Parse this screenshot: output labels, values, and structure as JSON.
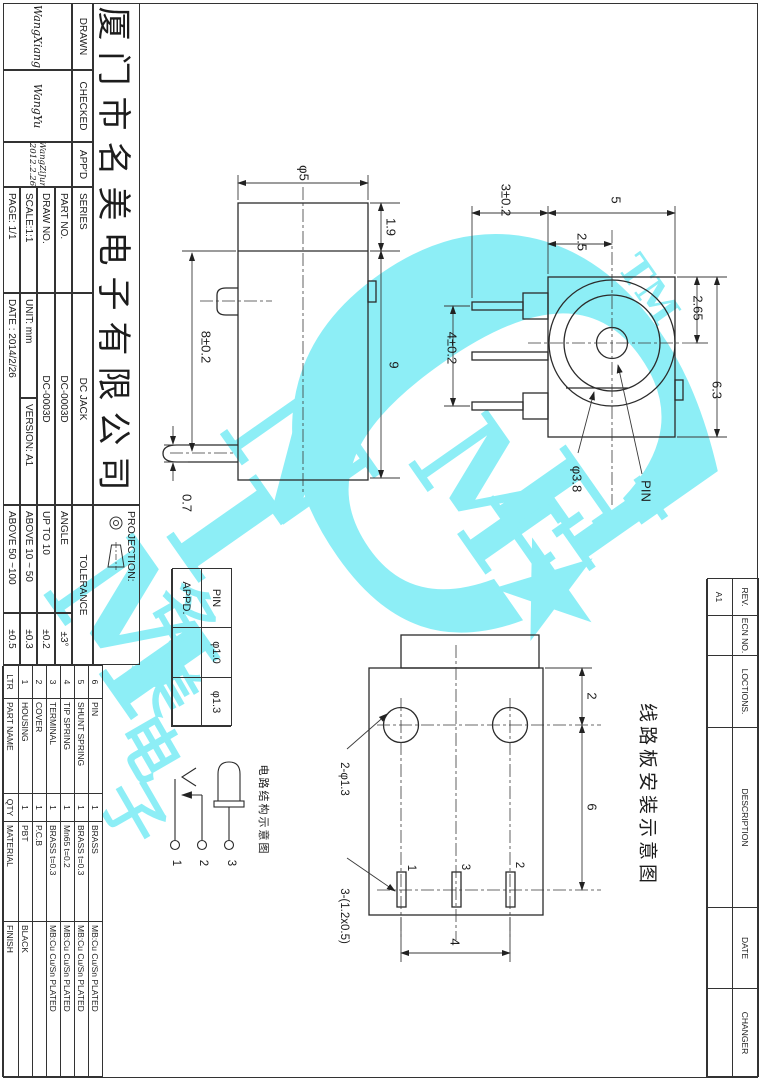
{
  "title_block": {
    "company": "厦门市名美电子有限公司",
    "drawn_label": "DRAWN",
    "drawn_sig": "WangXiang",
    "checked_label": "CHECKED",
    "checked_sig": "WangYu",
    "appd_label": "APP'D",
    "appd_sig": "WangZiJun",
    "appd_sig_date": "2012.2.26",
    "series_label": "SERIES",
    "series_value": "DC JACK",
    "part_no_label": "PART NO.",
    "part_no_value": "DC-0003D",
    "draw_no_label": "DRAW NO.",
    "draw_no_value": "DC-0003D",
    "scale": "SCALE:1:1",
    "unit": "UNIT: mm",
    "version": "VERSION: A1",
    "page": "PAGE: 1/1",
    "date": "DATE : 2014/2/26",
    "projection_label": "PROJECTION:",
    "tolerance": {
      "header": "TOLERANCE",
      "rows": [
        {
          "range": "ANGLE",
          "value": "±3°"
        },
        {
          "range": "UP TO 10",
          "value": "±0.2"
        },
        {
          "range": "ABOVE 10 ~ 50",
          "value": "±0.3"
        },
        {
          "range": "ABOVE 50 ~100",
          "value": "±0.5"
        }
      ]
    }
  },
  "parts_table": {
    "headers": {
      "ltr": "LTR",
      "name": "PART NAME",
      "qty": "QTY",
      "material": "MATERIAL",
      "finish": "FINISH"
    },
    "rows": [
      {
        "ltr": "6",
        "name": "PIN",
        "qty": "1",
        "material": "BRASS",
        "finish": "MB:Cu  Cu/Sn  PLATED"
      },
      {
        "ltr": "5",
        "name": "SHUNT SPRING",
        "qty": "1",
        "material": "BRASS t=0.3",
        "finish": "MB:Cu  Cu/Sn  PLATED"
      },
      {
        "ltr": "4",
        "name": "TIP SPRING",
        "qty": "1",
        "material": "Mn65 t=0.2",
        "finish": "MB:Cu  Cu/Sn  PLATED"
      },
      {
        "ltr": "3",
        "name": "TERMINAL",
        "qty": "1",
        "material": "BRASS t=0.3",
        "finish": "MB:Cu  Cu/Sn  PLATED"
      },
      {
        "ltr": "2",
        "name": "COVER",
        "qty": "1",
        "material": "P.C.B",
        "finish": ""
      },
      {
        "ltr": "1",
        "name": "HOUSING",
        "qty": "1",
        "material": "PBT",
        "finish": "BLACK"
      }
    ]
  },
  "pin_table": {
    "r1c1": "PIN",
    "r1c2": "φ1.0",
    "r1c3": "φ1.3",
    "r2c1": "APPD.",
    "r2c2": "",
    "r2c3": ""
  },
  "revision_table": {
    "rev_label": "REV.",
    "rev_value": "A1",
    "ecn_label": "ECN NO.",
    "ecn_value": "",
    "loc_label": "LOCTIONS.",
    "loc_value": "",
    "desc_label": "DESCRIPTION",
    "desc_value": "",
    "date_label": "DATE",
    "date_value": "",
    "changer_label": "CHANGER",
    "changer_value": ""
  },
  "dims": {
    "phi5": "φ5",
    "h19": "1.9",
    "h9": "9",
    "h8": "8±0.2",
    "h07": "0.7",
    "p3": "3±0.2",
    "w5": "5",
    "w25": "2.5",
    "h265": "2.65",
    "h63": "6.3",
    "p4": "4±0.2",
    "phi38": "φ3.8",
    "pin": "PIN",
    "b2": "2",
    "b6": "6",
    "b4": "4",
    "holes": "2-φ1.3",
    "slots": "3-(1.2x0.5)",
    "sl1": "1",
    "sl3": "3",
    "sl2": "2"
  },
  "annotations": {
    "pcb_title": "线路板安装示意图",
    "circuit_title": "电路结构示意图",
    "t1": "1",
    "t2": "2",
    "t3": "3"
  },
  "watermark": {
    "color": "#8deef6",
    "m1": "M",
    "i1": "I",
    "n1": "N",
    "c": "C",
    "m2": "M",
    "e": "E",
    "i2": "I",
    "tm": "TM",
    "star": "★",
    "cn1": "名",
    "cn2": "美",
    "cn3": "电",
    "cn4": "子"
  }
}
